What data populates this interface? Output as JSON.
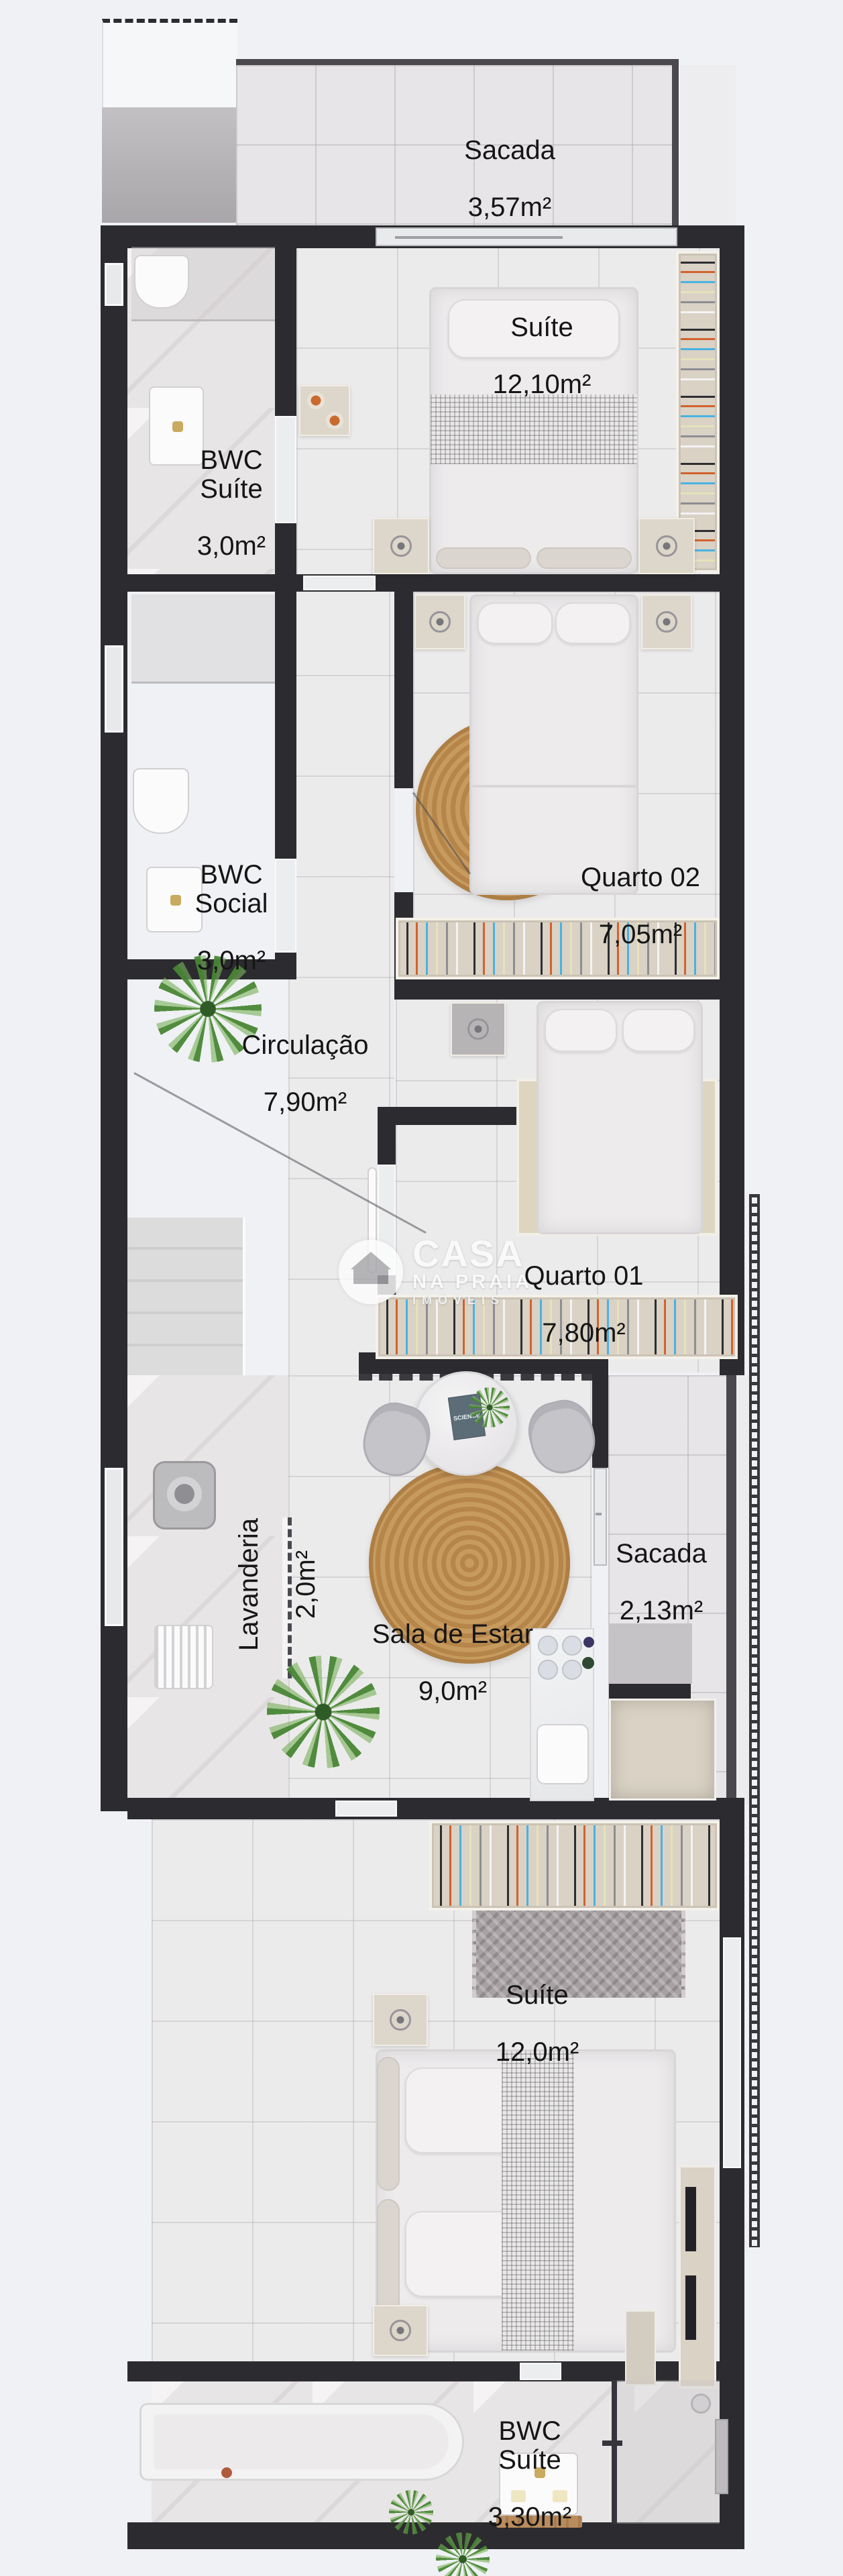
{
  "meta": {
    "title": "Planta baixa de apartamento (floor plan rendering)"
  },
  "colors": {
    "background": "#eff1f4",
    "wall": "#2c2b2f",
    "balcony_wall": "#4a484c",
    "floor": "#ecebec",
    "balcony_floor": "#e7e5e7",
    "wardrobe": "#d9d2c5",
    "rug_tan": "#c79a5e",
    "rug_gray": "#a7a1a3",
    "hanger_orange": "#d2622e",
    "hanger_blue": "#49b2e2",
    "plant_green": "#4c8a38",
    "label_text": "#151515",
    "gold_faucet": "#c9ab60"
  },
  "rooms": [
    {
      "id": "sacada-top",
      "name": "Sacada",
      "area": "3,57m²"
    },
    {
      "id": "suite-top",
      "name": "Suíte",
      "area": "12,10m²"
    },
    {
      "id": "bwc-suite-top",
      "name": "BWC\nSuíte",
      "area": "3,0m²"
    },
    {
      "id": "quarto-02",
      "name": "Quarto 02",
      "area": "7,05m²"
    },
    {
      "id": "bwc-social",
      "name": "BWC\nSocial",
      "area": "3,0m²"
    },
    {
      "id": "circulacao",
      "name": "Circulação",
      "area": "7,90m²"
    },
    {
      "id": "quarto-01",
      "name": "Quarto 01",
      "area": "7,80m²"
    },
    {
      "id": "lavanderia",
      "name": "Lavanderia",
      "area": "2,0m²"
    },
    {
      "id": "sacada-lateral",
      "name": "Sacada",
      "area": "2,13m²"
    },
    {
      "id": "sala-de-estar",
      "name": "Sala de Estar",
      "area": "9,0m²"
    },
    {
      "id": "suite-bottom",
      "name": "Suíte",
      "area": "12,0m²"
    },
    {
      "id": "bwc-suite-bottom",
      "name": "BWC\nSuíte",
      "area": "3,30m²"
    }
  ],
  "watermark": {
    "line1": "CASA",
    "line2": "NA PRAIA",
    "line3": "IMÓVEIS",
    "logo": "house-icon"
  },
  "decor": {
    "book_title": "SCIENCE"
  }
}
